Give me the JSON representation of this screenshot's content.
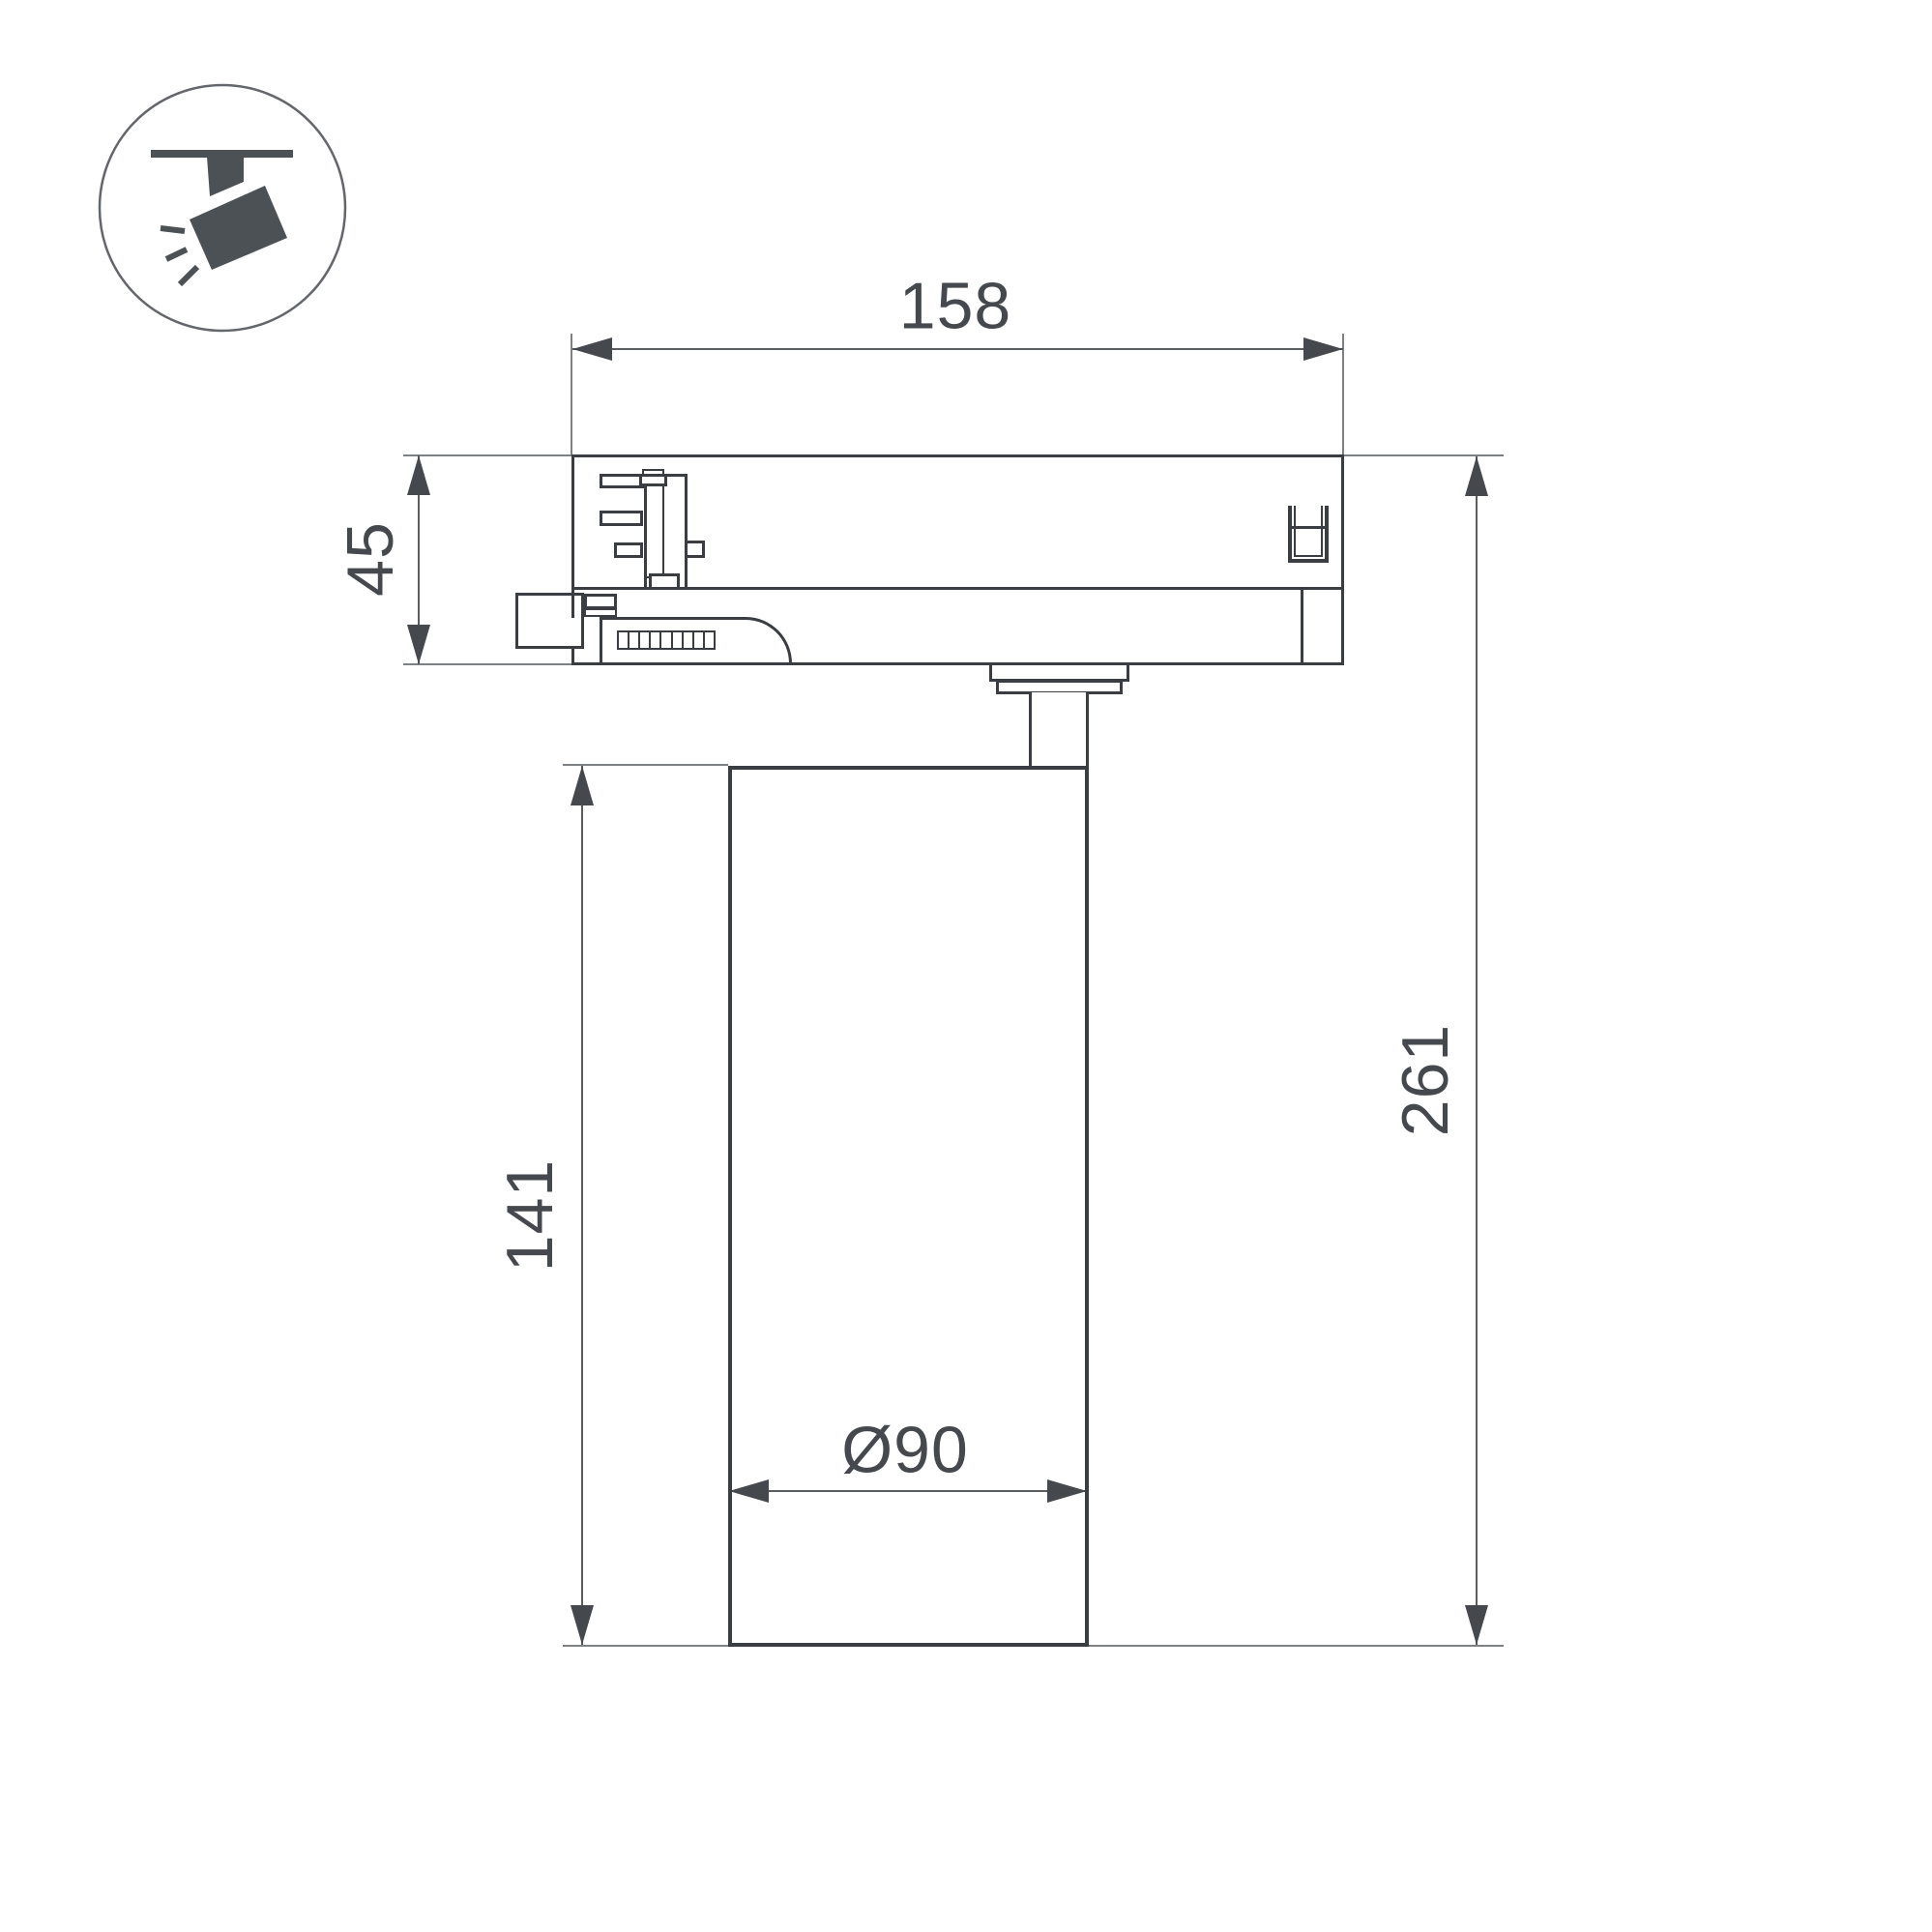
{
  "icon": {
    "name": "ceiling-track-spotlight-icon",
    "fill": "#4c5156",
    "circle_stroke": "#63666a"
  },
  "colors": {
    "outline": "#3a3d41",
    "dimension_line": "#5a5d60",
    "extension_line": "#7e8184",
    "arrow": "#45484c",
    "text": "#45484c",
    "background": "#ffffff"
  },
  "dims": {
    "track_width": "158",
    "adapter_height": "45",
    "body_height": "141",
    "total_height": "261",
    "diameter": "Ø90"
  }
}
